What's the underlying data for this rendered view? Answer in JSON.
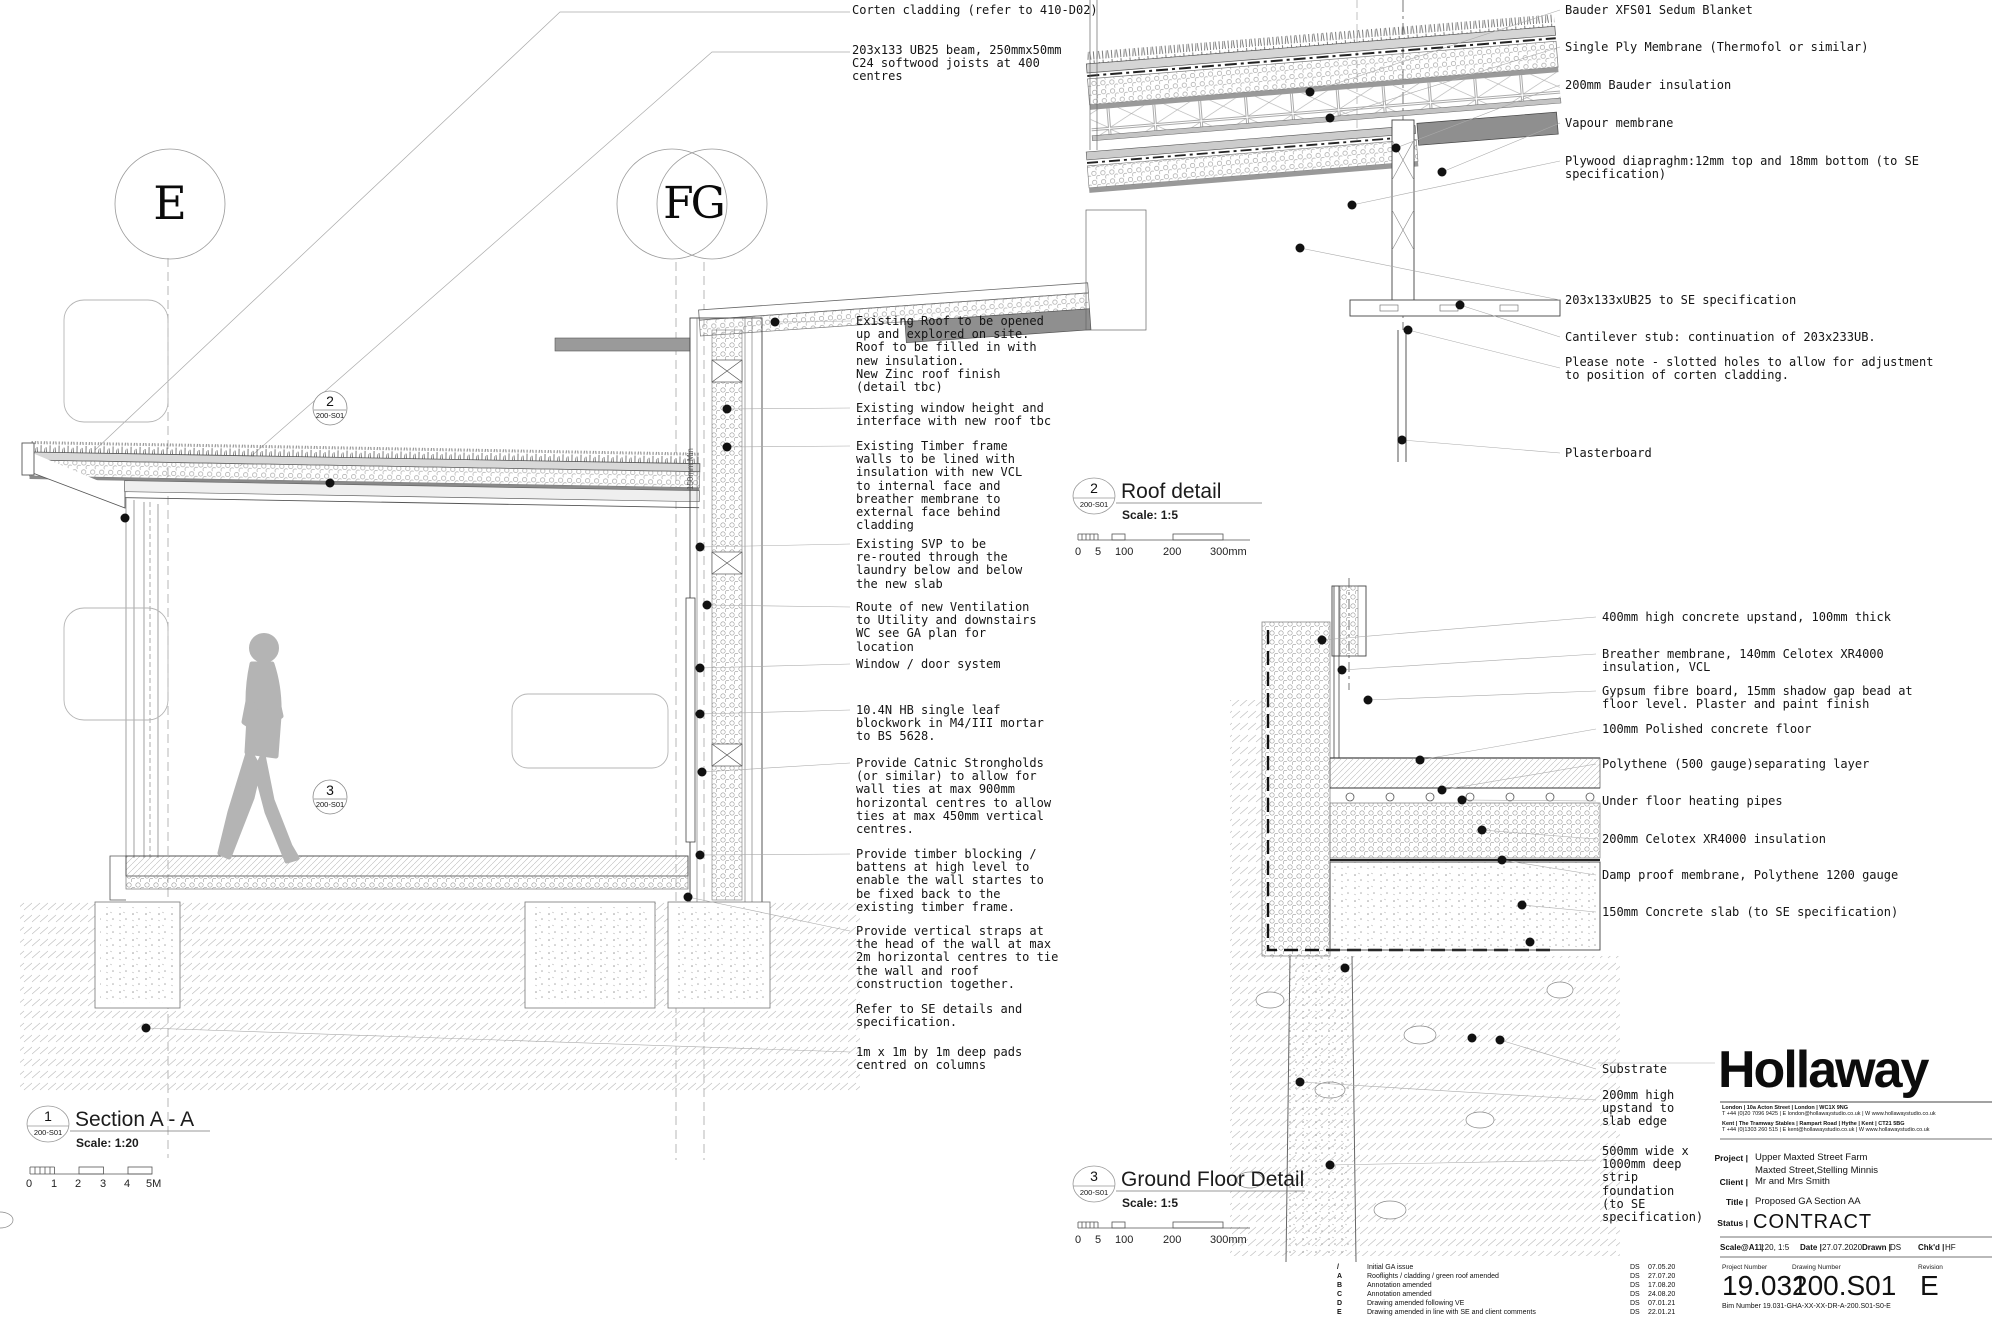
{
  "colors": {
    "ink": "#141414",
    "line": "#444444",
    "light_line": "#aaaaaa",
    "gray_fill": "#8f8f8f",
    "accent_none": "#ffffff"
  },
  "notes": {
    "top": [
      {
        "text": "Corten cladding (refer to 410-D02)"
      },
      {
        "text": "203x133 UB25 beam, 250mmx50mm\nC24 softwood joists at 400\ncentres"
      }
    ],
    "section": [
      {
        "text": "Existing Roof to be opened\nup and explored on site.\nRoof to be filled in with\nnew insulation.\nNew Zinc roof finish\n(detail tbc)"
      },
      {
        "text": "Existing window height and\ninterface with new roof tbc"
      },
      {
        "text": "Existing Timber frame\nwalls to be lined with\ninsulation with new VCL\nto internal face and\nbreather membrane to\nexternal face behind\ncladding"
      },
      {
        "text": "Existing SVP to be\nre-routed through the\nlaundry below and below\nthe new slab"
      },
      {
        "text": "Route of new Ventilation\nto Utility and downstairs\nWC see GA plan for\nlocation"
      },
      {
        "text": "Window / door system"
      },
      {
        "text": "10.4N HB single leaf\nblockwork in M4/III mortar\nto BS 5628."
      },
      {
        "text": "Provide Catnic Strongholds\n(or similar) to allow for\nwall ties at max 900mm\nhorizontal centres to allow\nties at max 450mm vertical\ncentres."
      },
      {
        "text": "Provide timber blocking /\nbattens at high level to\nenable the wall startes to\nbe fixed back to the\nexisting timber frame."
      },
      {
        "text": "Provide vertical straps at\nthe head of the wall at max\n2m horizontal centres to tie\nthe wall and roof\nconstruction together."
      },
      {
        "text": "Refer to SE details and\nspecification."
      },
      {
        "text": "1m x 1m by 1m deep pads\ncentred on columns"
      }
    ],
    "roof": [
      {
        "text": "Bauder XFS01 Sedum Blanket"
      },
      {
        "text": "Single Ply Membrane (Thermofol or similar)"
      },
      {
        "text": "200mm Bauder insulation"
      },
      {
        "text": "Vapour membrane"
      },
      {
        "text": "Plywood diapraghm:12mm top and 18mm bottom (to SE\nspecification)"
      },
      {
        "text": "203x133xUB25 to SE specification"
      },
      {
        "text": "Cantilever stub: continuation of 203x233UB."
      },
      {
        "text": "Please note - slotted holes to allow for adjustment\nto position of corten cladding."
      },
      {
        "text": "Plasterboard"
      }
    ],
    "floor": [
      {
        "text": "400mm high concrete upstand, 100mm thick"
      },
      {
        "text": "Breather membrane, 140mm Celotex XR4000\ninsulation, VCL"
      },
      {
        "text": "Gypsum fibre board, 15mm shadow gap bead at\nfloor level. Plaster and paint finish"
      },
      {
        "text": "100mm Polished concrete floor"
      },
      {
        "text": "Polythene (500 gauge)separating layer"
      },
      {
        "text": "Under floor heating pipes"
      },
      {
        "text": "200mm Celotex XR4000 insulation"
      },
      {
        "text": "Damp proof membrane, Polythene 1200 gauge"
      },
      {
        "text": "150mm Concrete slab (to SE specification)"
      }
    ],
    "ground": [
      {
        "text": "Substrate"
      },
      {
        "text": "200mm high\nupstand to\nslab edge"
      },
      {
        "text": "500mm wide x\n1000mm deep\nstrip\nfoundation\n(to SE\nspecification)"
      }
    ],
    "min_label": "150mm Min"
  },
  "views": {
    "section": {
      "num": "1",
      "ref": "200-S01",
      "title": "Section A - A",
      "scale": "Scale: 1:20"
    },
    "roof": {
      "num": "2",
      "ref": "200-S01",
      "title": "Roof detail",
      "scale": "Scale: 1:5"
    },
    "floor": {
      "num": "3",
      "ref": "200-S01",
      "title": "Ground Floor Detail",
      "scale": "Scale: 1:5"
    }
  },
  "callouts": {
    "roof": {
      "num": "2",
      "ref": "200-S01"
    },
    "floor": {
      "num": "3",
      "ref": "200-S01"
    }
  },
  "grid": {
    "e": "E",
    "fg": "FG"
  },
  "scalebars": {
    "m": [
      "0",
      "1",
      "2",
      "3",
      "4",
      "5M"
    ],
    "mm": [
      "0",
      "5",
      "100",
      "200",
      "300mm"
    ]
  },
  "titleblock": {
    "logo": "Hollaway",
    "address1a": "London | 10a Acton Street | London | WC1X 9NG",
    "address1b": "T +44 (0)20 7096 9425 | E london@hollawaystudio.co.uk | W www.hollawaystudio.co.uk",
    "address2a": "Kent | The Tramway Stables | Rampart Road | Hythe | Kent | CT21 5BG",
    "address2b": "T +44 (0)1303 260 515 | E kent@hollawaystudio.co.uk | W www.hollawaystudio.co.uk",
    "project_label": "Project |",
    "project_value": "Upper Maxted Street Farm",
    "project_value2": "Maxted Street,Stelling Minnis",
    "client_label": "Client |",
    "client_value": "Mr and Mrs Smith",
    "title_label": "Title |",
    "title_value": "Proposed GA Section AA",
    "status_label": "Status |",
    "status_value": "CONTRACT",
    "scale_label": "Scale@A1 |",
    "scale_value": "1:20, 1:5",
    "date_label": "Date |",
    "date_value": "27.07.2020",
    "drawn_label": "Drawn |",
    "drawn_value": "DS",
    "chkd_label": "Chk'd |",
    "chkd_value": "HF",
    "project_number_label": "Project Number",
    "project_number": "19.031",
    "drawing_number_label": "Drawing Number",
    "drawing_number": "200.S01",
    "revision_label": "Revision",
    "revision": "E",
    "bim_label": "Bim Number",
    "bim_number": "19.031-GHA-XX-XX-DR-A-200.S01-S0-E"
  },
  "revisions": [
    {
      "rev": "/",
      "desc": "Initial GA issue",
      "by": "DS",
      "date": "07.05.20"
    },
    {
      "rev": "A",
      "desc": "Rooflights / cladding / green roof amended",
      "by": "DS",
      "date": "27.07.20"
    },
    {
      "rev": "B",
      "desc": "Annotation amended",
      "by": "DS",
      "date": "17.08.20"
    },
    {
      "rev": "C",
      "desc": "Annotation amended",
      "by": "DS",
      "date": "24.08.20"
    },
    {
      "rev": "D",
      "desc": "Drawing amended following VE",
      "by": "DS",
      "date": "07.01.21"
    },
    {
      "rev": "E",
      "desc": "Drawing amended in line with SE and client comments",
      "by": "DS",
      "date": "22.01.21"
    }
  ]
}
